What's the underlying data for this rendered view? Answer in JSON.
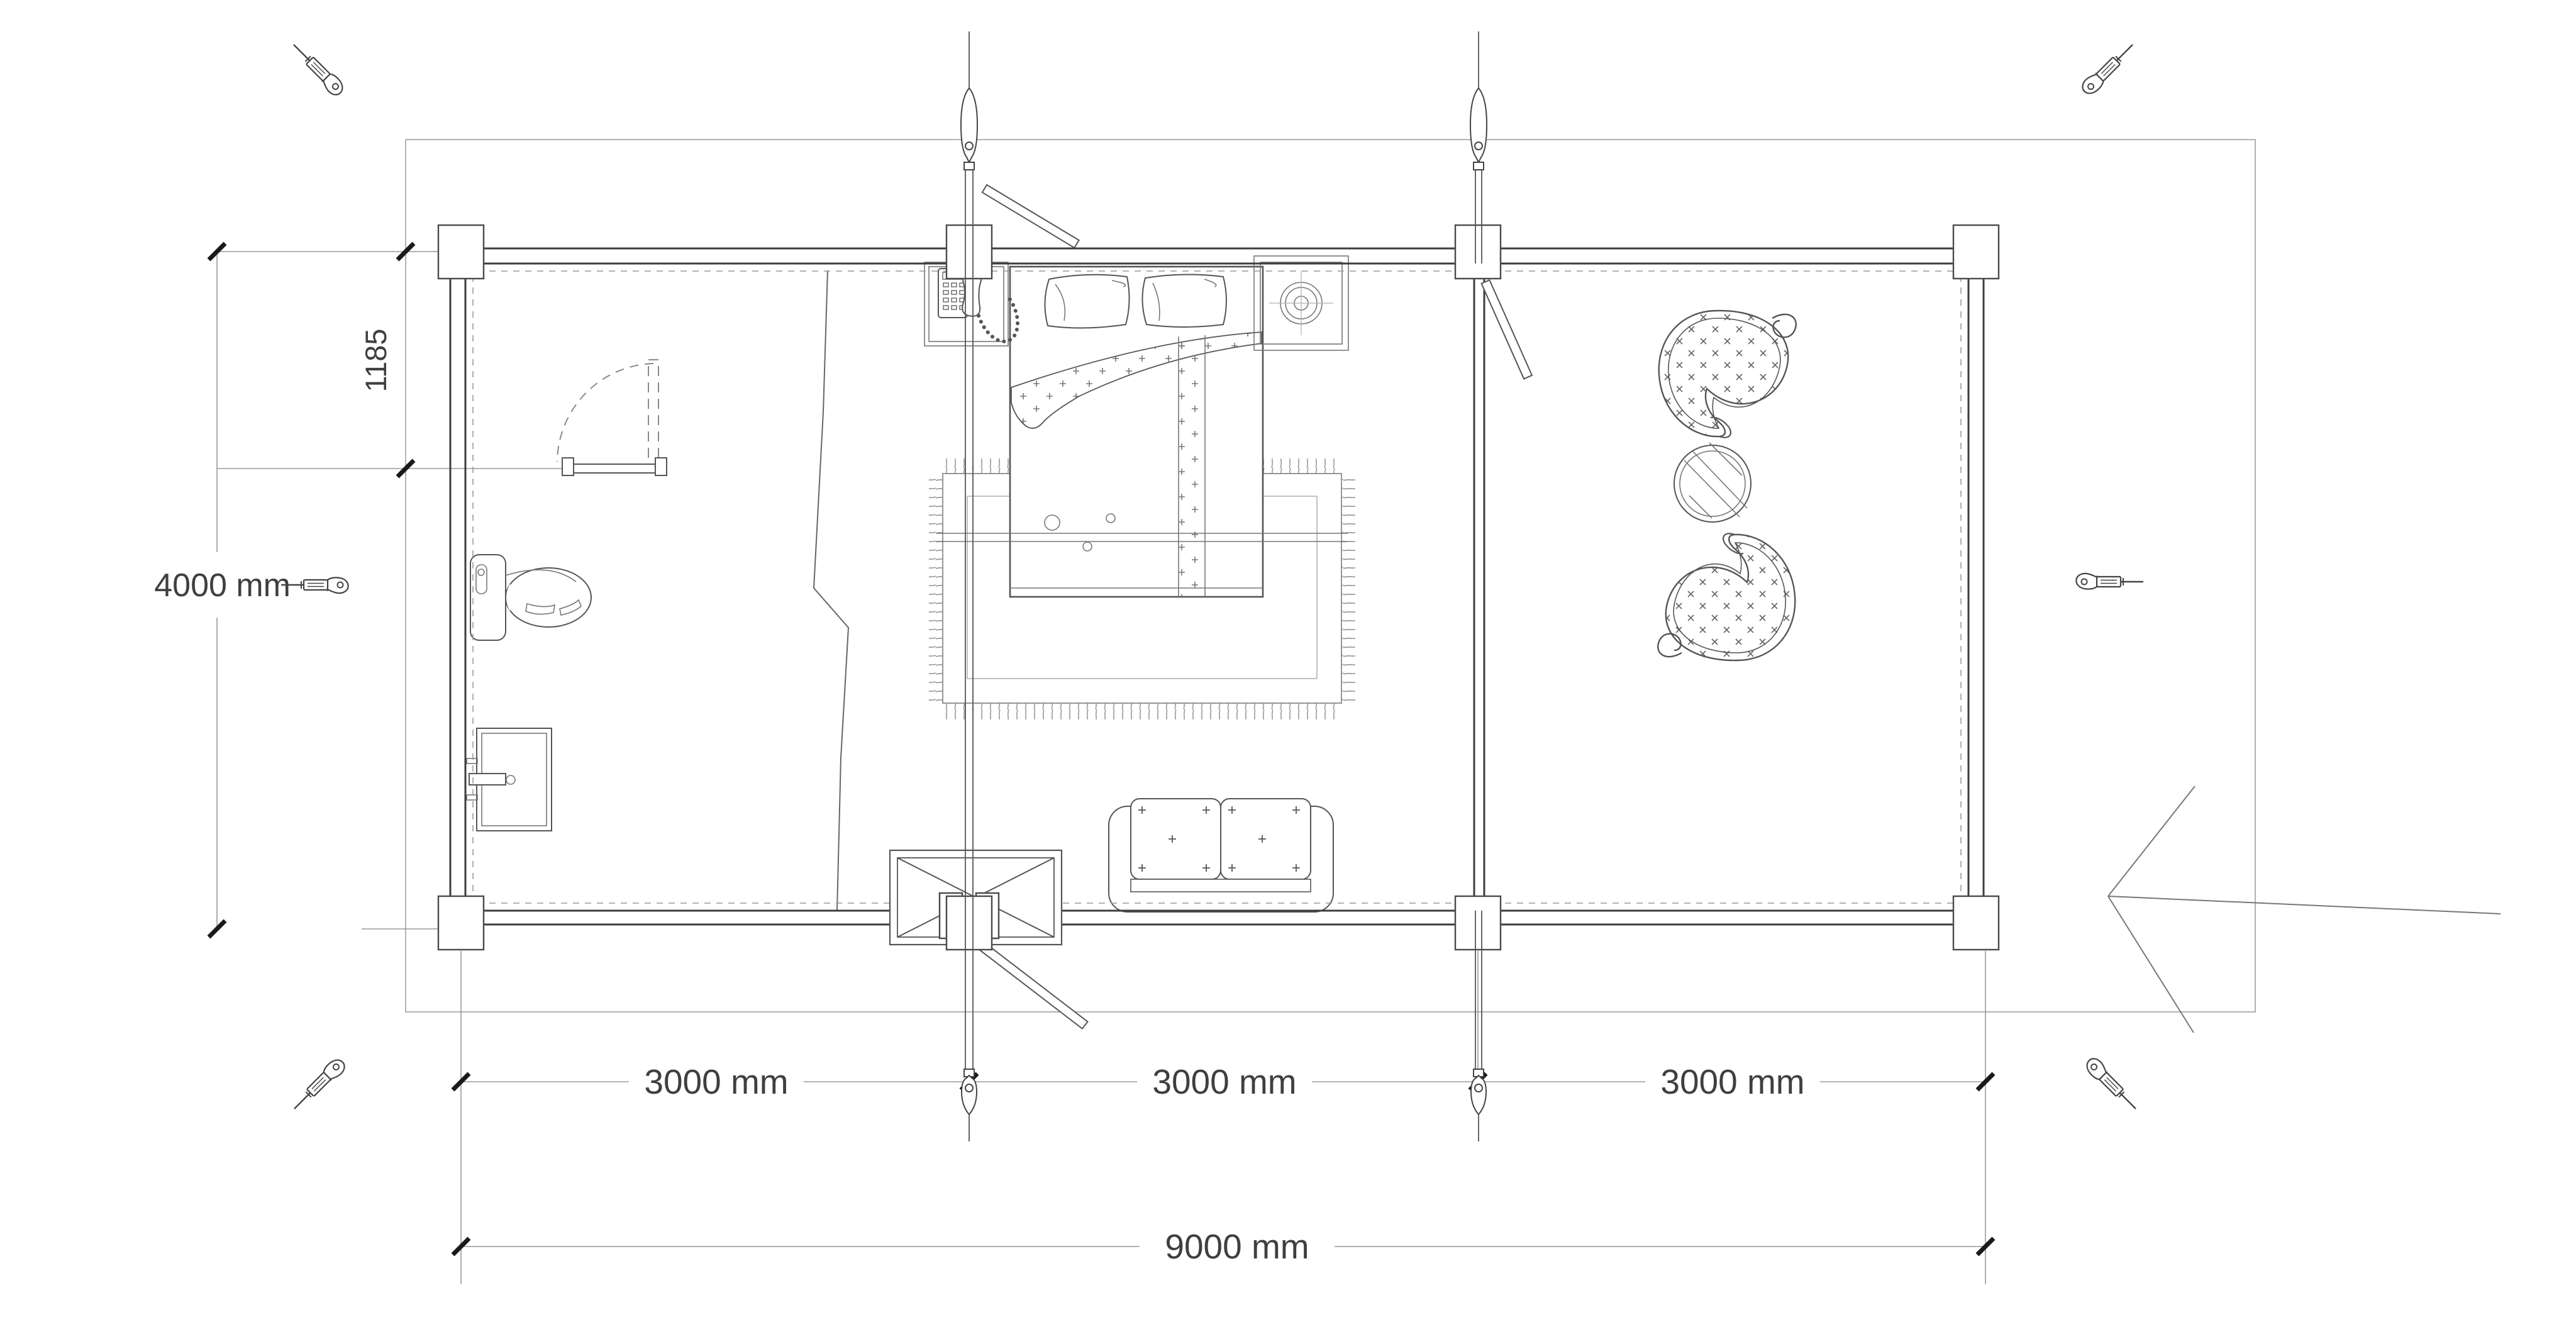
{
  "plan": {
    "title": "Log cabin floor plan, top view",
    "colors": {
      "background": "#ffffff",
      "wall_line": "#3d3d3d",
      "object_line": "#555555",
      "thin_line": "#9a9a9a",
      "dimension_text": "#3f3f3f",
      "tick_mark": "#1a1a1a"
    },
    "dimensions": {
      "depth_label": "4000 mm",
      "door_offset_label": "1185",
      "bay_labels": [
        "3000 mm",
        "3000 mm",
        "3000 mm"
      ],
      "total_width_label": "9000 mm"
    },
    "icons": [
      "turnbuckle-icon-top-left",
      "turnbuckle-icon-top-right",
      "turnbuckle-icon-middle-left",
      "turnbuckle-icon-middle-right",
      "turnbuckle-icon-bottom-left",
      "turnbuckle-icon-bottom-right",
      "storm-brace-needle-icons",
      "entrance-arrow-icon"
    ],
    "rooms": {
      "bathroom_fixtures": [
        "toilet",
        "washbasin",
        "bathroom-door",
        "shower-screen-zigzag"
      ],
      "bedroom_furniture": [
        "double-bed",
        "pillows",
        "fringed-rug",
        "bedside-table-with-telephone",
        "bedside-table-with-lamp",
        "sofa",
        "entry-door"
      ],
      "terrace_furniture": [
        "wicker-chair-top",
        "round-slatted-table",
        "wicker-chair-bottom"
      ]
    }
  }
}
